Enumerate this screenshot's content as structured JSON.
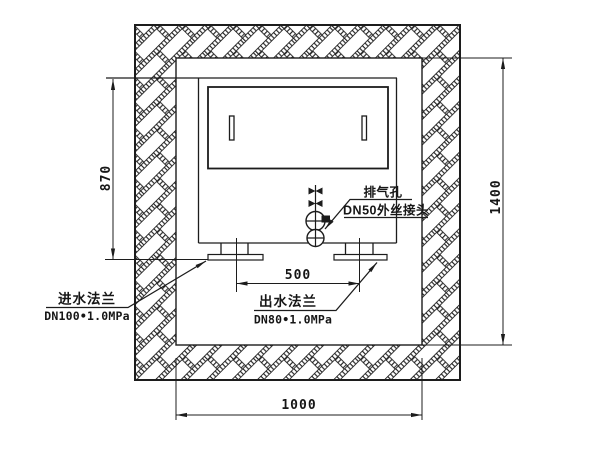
{
  "drawing": {
    "dimensions": {
      "left_height": "870",
      "right_height": "1400",
      "flange_spacing": "500",
      "pit_width": "1000"
    },
    "labels": {
      "exhaust_name": "排气孔",
      "exhaust_spec": "DN50外丝接头",
      "inlet_name": "进水法兰",
      "inlet_spec": "DN100•1.0MPa",
      "outlet_name": "出水法兰",
      "outlet_spec": "DN80•1.0MPa"
    },
    "colors": {
      "line": "#1c1c1c",
      "background": "#ffffff"
    }
  }
}
